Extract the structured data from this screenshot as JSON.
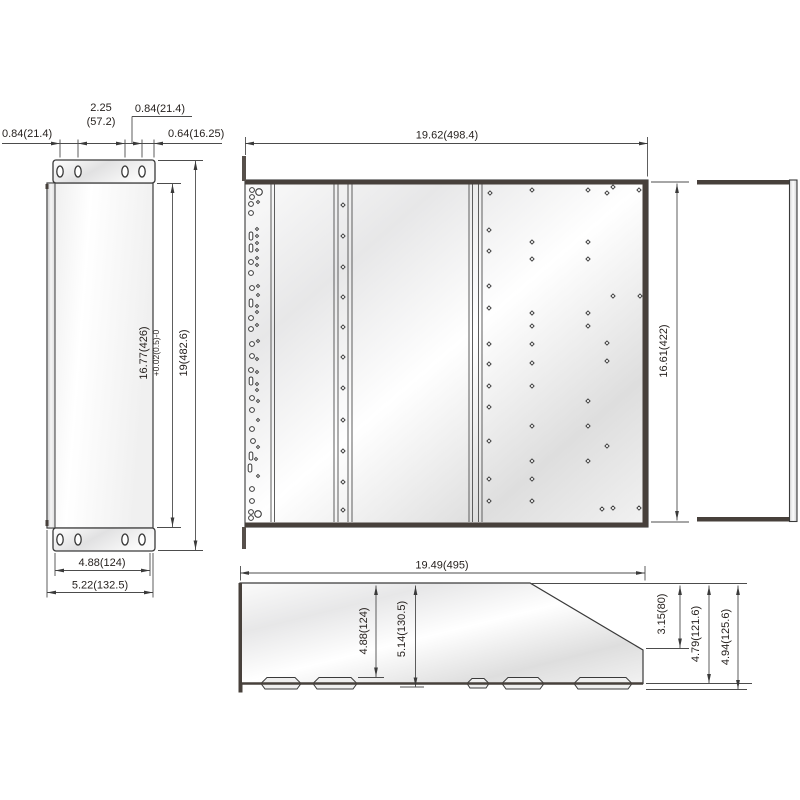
{
  "drawing_title": "rack chassis dimensional drawing",
  "accent_colors": {
    "edge_dark": "#47403b",
    "outline": "#3a3a3a",
    "dim_line": "#4c4c4c",
    "text": "#241f1c"
  },
  "views": {
    "left": {
      "name": "left side flange view",
      "dim_hole_left": "0.84(21.4)",
      "dim_hole_pitch": "2.25",
      "dim_hole_pitch_mm": "(57.2)",
      "dim_hole_top": "0.84(21.4)",
      "dim_hole_right": "0.64(16.25)",
      "dim_opening": "16.77(426)",
      "dim_opening_tol": "+0.02(0.5)-0",
      "dim_height": "19(482.6)",
      "dim_flange": "4.88(124)",
      "dim_width": "5.22(132.5)"
    },
    "front": {
      "name": "front panel view",
      "dim_width": "19.62(498.4)",
      "dim_height": "16.61(422)"
    },
    "channel": {
      "name": "right channel edge view"
    },
    "profile": {
      "name": "bottom profile view",
      "dim_width": "19.49(495)",
      "dim_h_inner": "4.88(124)",
      "dim_h_mid": "5.14(130.5)",
      "dim_step": "3.15(80)",
      "dim_h_right": "4.79(121.6)",
      "dim_h_overall": "4.94(125.6)"
    }
  },
  "holes": {
    "left_flange_top": [
      [
        60,
        171.5
      ],
      [
        78,
        171.5
      ],
      [
        125,
        171.5
      ],
      [
        142,
        171.5
      ]
    ],
    "left_flange_bottom": [
      [
        60,
        539.5
      ],
      [
        78,
        539.5
      ],
      [
        125,
        539.5
      ],
      [
        142,
        539.5
      ]
    ],
    "rail_column": [
      [
        252,
        190,
        "c"
      ],
      [
        252,
        197,
        "c"
      ],
      [
        259,
        192,
        "C"
      ],
      [
        251,
        204,
        "c"
      ],
      [
        258,
        202,
        "d"
      ],
      [
        251,
        213,
        "c"
      ],
      [
        257,
        229,
        "d"
      ],
      [
        251,
        236,
        "s"
      ],
      [
        257,
        236,
        "d"
      ],
      [
        257,
        243,
        "d"
      ],
      [
        251,
        248,
        "s"
      ],
      [
        257,
        250,
        "d"
      ],
      [
        257,
        258,
        "d"
      ],
      [
        251,
        262,
        "c"
      ],
      [
        257,
        265,
        "d"
      ],
      [
        251,
        273,
        "c"
      ],
      [
        258,
        286,
        "d"
      ],
      [
        252,
        288,
        "c"
      ],
      [
        258,
        295,
        "d"
      ],
      [
        251,
        303,
        "s"
      ],
      [
        257,
        306,
        "d"
      ],
      [
        257,
        312,
        "d"
      ],
      [
        251,
        318,
        "c"
      ],
      [
        257,
        325,
        "d"
      ],
      [
        251,
        329,
        "c"
      ],
      [
        258,
        341,
        "d"
      ],
      [
        252,
        344,
        "c"
      ],
      [
        252,
        356,
        "c"
      ],
      [
        257,
        359,
        "d"
      ],
      [
        251,
        370,
        "c"
      ],
      [
        257,
        372,
        "d"
      ],
      [
        251,
        381,
        "s"
      ],
      [
        257,
        384,
        "d"
      ],
      [
        257,
        390,
        "d"
      ],
      [
        252,
        398,
        "c"
      ],
      [
        258,
        401,
        "d"
      ],
      [
        252,
        410,
        "c"
      ],
      [
        258,
        420,
        "d"
      ],
      [
        252,
        429,
        "c"
      ],
      [
        253,
        441,
        "c"
      ],
      [
        258,
        447,
        "d"
      ],
      [
        251,
        456,
        "s"
      ],
      [
        256,
        459,
        "d"
      ],
      [
        250,
        468,
        "s"
      ],
      [
        258,
        476,
        "d"
      ],
      [
        252,
        489,
        "c"
      ],
      [
        252,
        501,
        "c"
      ],
      [
        251,
        512,
        "c"
      ],
      [
        251,
        518,
        "c"
      ],
      [
        258,
        514,
        "C"
      ]
    ],
    "center_column": {
      "x": 343,
      "ys": [
        205,
        236,
        267,
        297,
        327,
        357,
        388,
        420,
        451,
        482,
        510
      ]
    },
    "panel_scatter": [
      [
        490,
        193
      ],
      [
        532,
        190
      ],
      [
        588,
        190
      ],
      [
        607,
        193
      ],
      [
        613,
        187
      ],
      [
        639,
        190
      ],
      [
        489,
        230
      ],
      [
        532,
        242
      ],
      [
        588,
        242
      ],
      [
        489,
        251
      ],
      [
        532,
        259
      ],
      [
        588,
        259
      ],
      [
        489,
        286
      ],
      [
        613,
        296
      ],
      [
        640,
        296
      ],
      [
        489,
        308
      ],
      [
        532,
        313
      ],
      [
        588,
        313
      ],
      [
        532,
        326
      ],
      [
        588,
        326
      ],
      [
        489,
        344
      ],
      [
        532,
        344
      ],
      [
        607,
        343
      ],
      [
        489,
        364
      ],
      [
        532,
        363
      ],
      [
        607,
        361
      ],
      [
        489,
        386
      ],
      [
        532,
        386
      ],
      [
        489,
        407
      ],
      [
        588,
        401
      ],
      [
        532,
        426
      ],
      [
        588,
        426
      ],
      [
        489,
        441
      ],
      [
        607,
        446
      ],
      [
        532,
        461
      ],
      [
        588,
        461
      ],
      [
        489,
        479
      ],
      [
        532,
        479
      ],
      [
        489,
        501
      ],
      [
        532,
        501
      ],
      [
        602,
        509
      ],
      [
        613,
        508
      ],
      [
        639,
        508
      ]
    ]
  }
}
